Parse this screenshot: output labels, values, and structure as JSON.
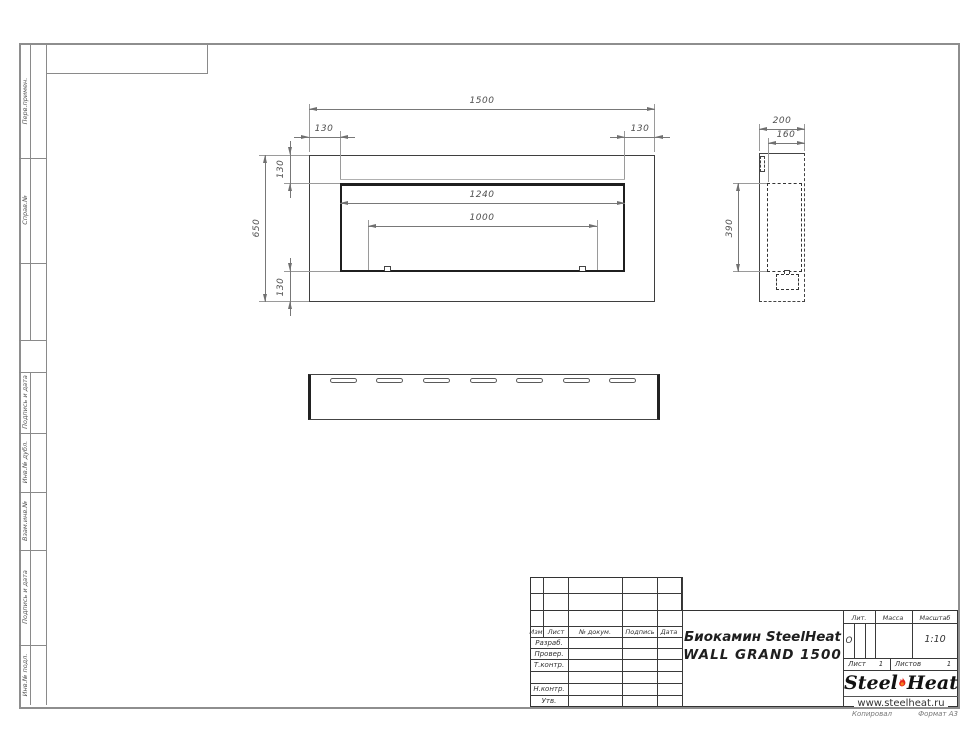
{
  "colors": {
    "line": "#3c3c3c",
    "dim_line": "#787878",
    "frame": "#8e8e8e",
    "flame_red": "#e2231a",
    "flame_orange": "#f58220"
  },
  "margin_labels": {
    "0": "Перв.примен.",
    "1": "Справ.№",
    "2": "Подпись и дата",
    "3": "Инв.№ дубл.",
    "4": "Взам.инв.№",
    "5": "Подпись и дата",
    "6": "Инв.№ подл."
  },
  "dims": {
    "front": {
      "total": "1500",
      "off_left": "130",
      "off_right": "130",
      "off_top": "130",
      "height": "650",
      "off_bottom": "130",
      "opening": "1240",
      "burner": "1000"
    },
    "side": {
      "depth": "200",
      "inner_depth": "160",
      "opening_height": "390"
    }
  },
  "title_block": {
    "header_cols": {
      "izm": "Изм.",
      "list": "Лист",
      "doc": "№ докум.",
      "sign": "Подпись",
      "date": "Дата"
    },
    "row_labels": {
      "0": "Разраб.",
      "1": "Провер.",
      "2": "Т.контр.",
      "3": "Н.контр.",
      "4": "Утв."
    },
    "product_line1": "Биокамин SteelHeat",
    "product_line2": "WALL GRAND 1500",
    "lit_label": "Лит.",
    "lit_value": "О",
    "mass_label": "Масса",
    "scale_label": "Масштаб",
    "scale_value": "1:10",
    "sheet_label": "Лист",
    "sheet_value": "1",
    "sheets_label": "Листов",
    "sheets_value": "1",
    "logo_steel": "Steel",
    "logo_heat": "Heat",
    "logo_url": "www.steelheat.ru"
  },
  "footer": {
    "copied": "Копировал",
    "format": "Формат А3"
  }
}
